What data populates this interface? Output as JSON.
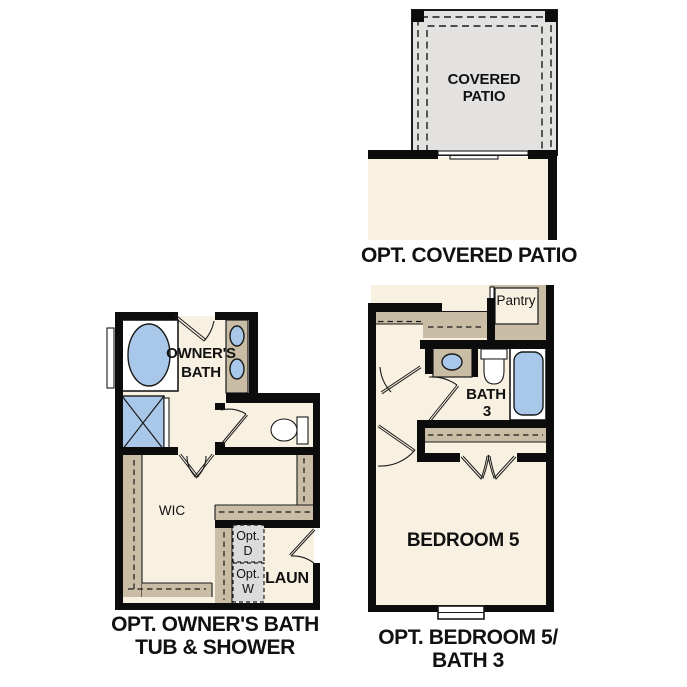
{
  "colors": {
    "wall": "#0c0c0c",
    "line": "#1a1a1a",
    "room_fill": "#f8f1e2",
    "patio_fill": "#e3e2e0",
    "cabinet_tan": "#c9bda6",
    "fixture_blue": "#a9c8e9",
    "appliance_gray": "#dbdbdb",
    "text": "#111111"
  },
  "plans": {
    "covered_patio": {
      "room_label": [
        "COVERED",
        "PATIO"
      ],
      "caption": "OPT. COVERED PATIO"
    },
    "owners_bath": {
      "caption": [
        "OPT. OWNER'S BATH",
        "TUB & SHOWER"
      ],
      "labels": {
        "owners_bath": [
          "OWNER'S",
          "BATH"
        ],
        "wic": "WIC",
        "laundry": "LAUN",
        "opt_dryer": [
          "Opt.",
          "D"
        ],
        "opt_washer": [
          "Opt.",
          "W"
        ]
      }
    },
    "bedroom5_bath3": {
      "caption": [
        "OPT. BEDROOM 5/",
        "BATH 3"
      ],
      "labels": {
        "pantry": "Pantry",
        "bath3": [
          "BATH",
          "3"
        ],
        "bedroom5": "BEDROOM 5"
      }
    }
  }
}
